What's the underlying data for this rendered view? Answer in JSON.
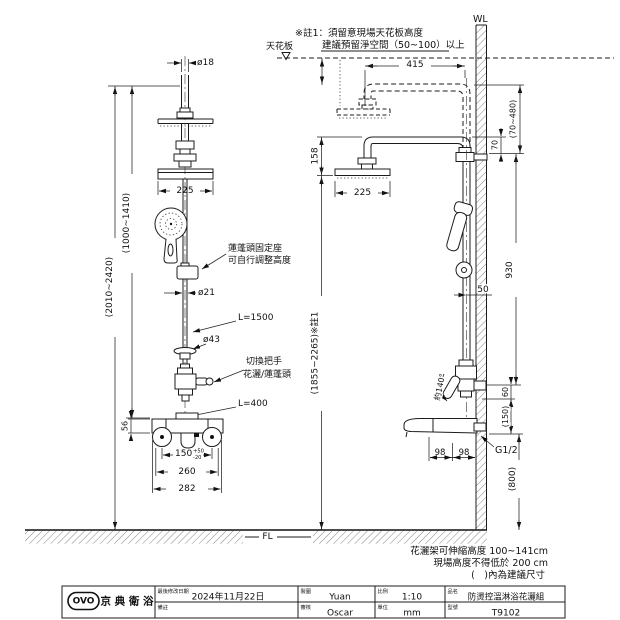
{
  "drawing": {
    "top_note_line1": "※註1：須留意現場天花板高度",
    "top_note_line2": "建議預留淨空間（50~100）以上",
    "ceiling_label": "天花板",
    "wall_line_label": "WL",
    "floor_line_label": "FL",
    "front": {
      "dia_pipe": "ø18",
      "head_width": "225",
      "holder_note1": "蓮蓬頭固定座",
      "holder_note2": "可自行調整高度",
      "dia_bar": "ø21",
      "hose_length": "L=1500",
      "dia_flange": "ø43",
      "switch_note1": "切換把手",
      "switch_note2": "花灑/蓮蓬頭",
      "inlet_length": "L=400",
      "height_total": "(2010~2420)",
      "height_bar": "(1000~1410)",
      "valve_body_height": "56",
      "center_distance": "150",
      "tol_plus": "+50",
      "tol_minus": "-20",
      "width_body": "260",
      "width_overall": "282"
    },
    "side": {
      "arm_reach": "415",
      "range_riser": "(70~480)",
      "offset_70": "70",
      "drop_158": "158",
      "head_width": "225",
      "riser_930": "930",
      "wall_50": "50",
      "height_head": "(1855~2265)※註1",
      "angle": "約140°",
      "valve_60": "60",
      "spout_150": "(150)",
      "spout_98a": "98",
      "spout_98b": "98",
      "thread": "G1/2",
      "height_800": "(800)"
    },
    "bottom_notes": {
      "line1": "花灑架可伸縮高度 100~141cm",
      "line2": "現場高度不得低於 200 cm",
      "line3": "(　)內為建議尺寸"
    }
  },
  "title_block": {
    "logo": "OVO",
    "brand": "京 典 衛 浴",
    "fields": [
      {
        "label": "最後修改日期",
        "value": "2024年11月22日"
      },
      {
        "label": "備註",
        "value": ""
      },
      {
        "label": "製圖",
        "value": "Yuan"
      },
      {
        "label": "審核",
        "value": "Oscar"
      },
      {
        "label": "比例",
        "value": "1:10"
      },
      {
        "label": "單位",
        "value": "mm"
      },
      {
        "label": "品名",
        "value": "防燙控溫淋浴花灑組"
      },
      {
        "label": "型號",
        "value": "T9102"
      }
    ]
  }
}
